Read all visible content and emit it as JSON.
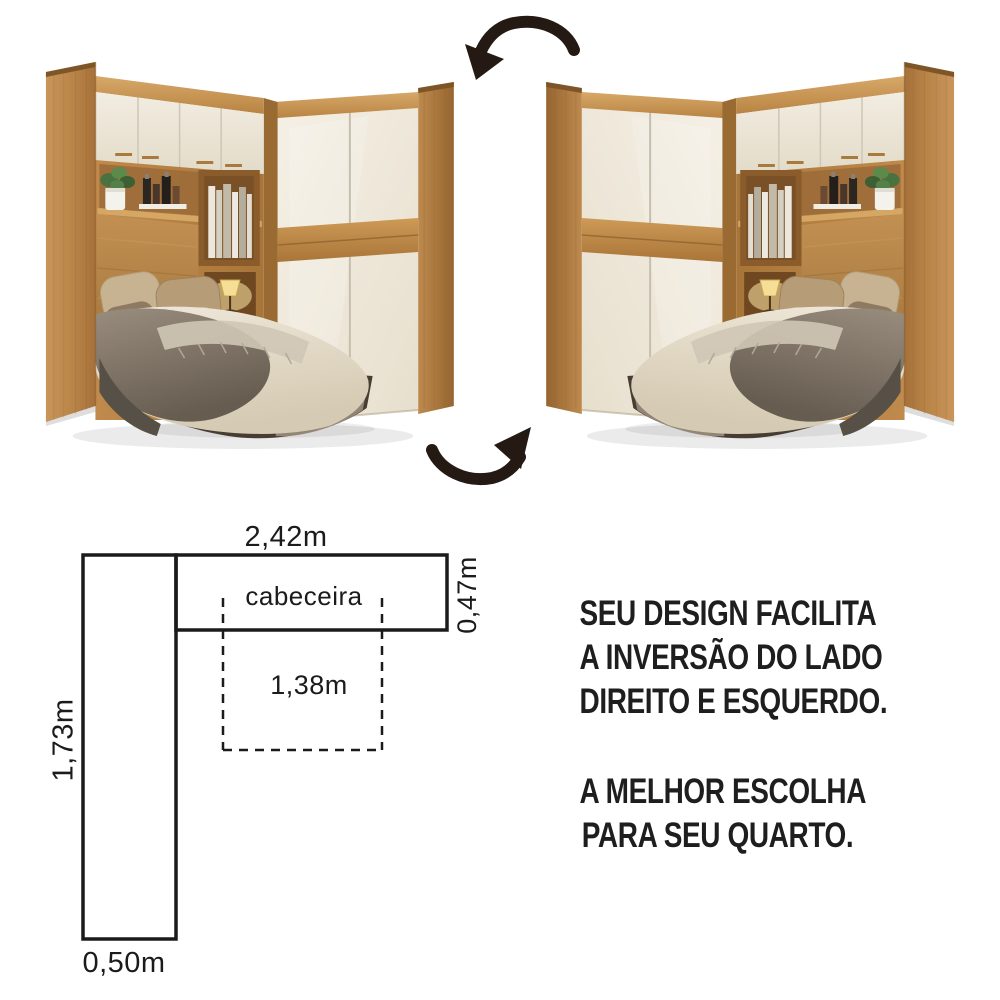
{
  "page": {
    "background": "#ffffff"
  },
  "hero": {
    "flip_arrow_top": "curved-arrow-counterclockwise",
    "flip_arrow_bottom": "curved-arrow-clockwise",
    "arrow_color": "#241a13",
    "palette": {
      "wood": "#c08a4c",
      "wood_dark": "#9a6a33",
      "wood_light": "#d7a868",
      "cream_door": "#f2ecdf",
      "headboard": "#b8854a",
      "duvet": "#e8dfcc",
      "blanket": "#8d8173",
      "bed_base": "#473d32",
      "bed_base_light": "#9a8d7d",
      "pillow_light": "#c7b392",
      "pillow_mid": "#b69c77",
      "pillow_dark": "#8d7a61",
      "lamp": "#f5df96",
      "plant": "#4a7240"
    }
  },
  "floor_plan": {
    "line_color": "#1b1b1b",
    "labels": {
      "top_width": "2,42m",
      "right_depth": "0,47m",
      "left_height": "1,73m",
      "bottom_width": "0,50m",
      "bed_width": "1,38m",
      "headboard": "cabeceira"
    }
  },
  "marketing": {
    "text_color": "#1e1e1e",
    "para1_lines": [
      "SEU DESIGN FACILITA",
      "A INVERSÃO DO LADO",
      "DIREITO E ESQUERDO."
    ],
    "para2_lines": [
      "A MELHOR ESCOLHA",
      "PARA SEU QUARTO."
    ]
  }
}
